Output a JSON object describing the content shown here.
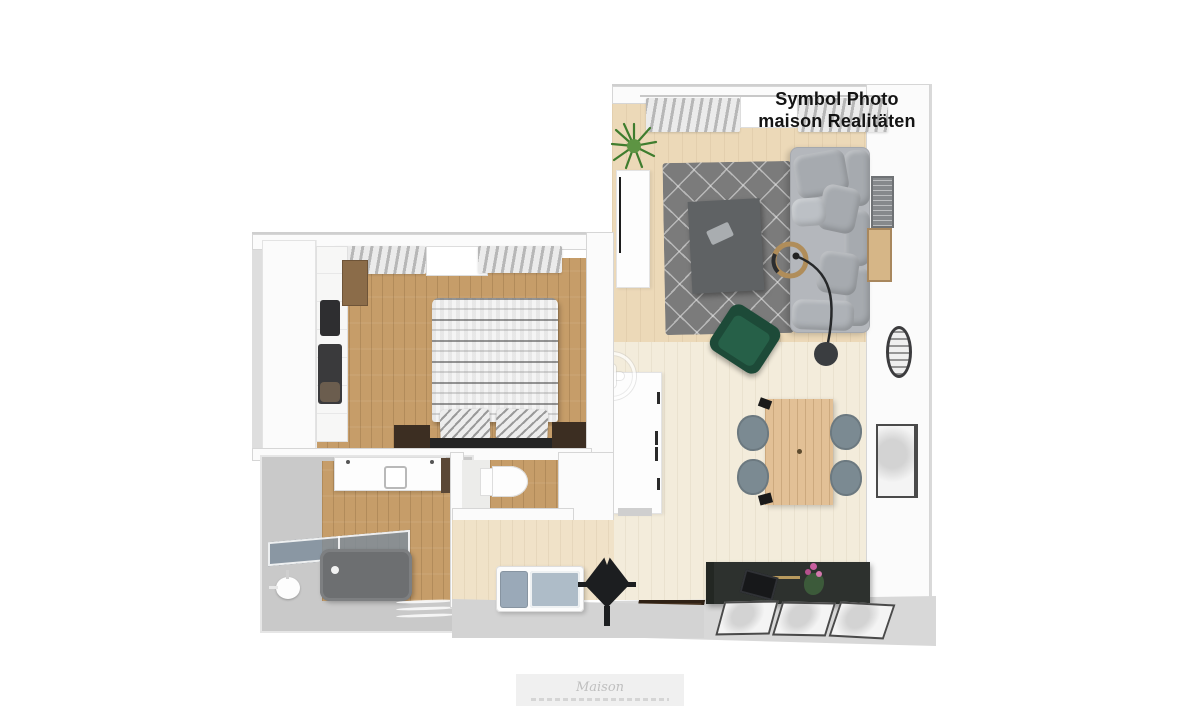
{
  "overlay_caption": {
    "line1": "Symbol Photo",
    "line2": "maison Realitäten"
  },
  "footer_watermark": {
    "text": "Maison"
  },
  "colors": {
    "text-black": "#141414",
    "wall-white": "#fbfbfb",
    "wall-edge": "#d6d6d6",
    "floor-tan": "#ecd9b8",
    "floor-pale": "#f3ecdb",
    "floor-wood": "#c69d69",
    "floor-hall": "#f0e2c8",
    "floor-gray": "#c9c9c9",
    "rug-gray": "#7b7b7b",
    "sofa-base": "#b4b7bc",
    "sofa-cushion": "#a6aaaf",
    "coffee-table": "#5f6264",
    "chair-green": "#1d4a38",
    "table-wood": "#e2c096",
    "chair-blue": "#7b8a92",
    "dark-furniture": "#2d312e",
    "mat-brown": "#45311f",
    "bathtub-gray": "#6d6f71",
    "glass-blue": "#8494a3",
    "plant-green": "#3f7d2e",
    "watermark-gray": "#bfbfbf"
  }
}
